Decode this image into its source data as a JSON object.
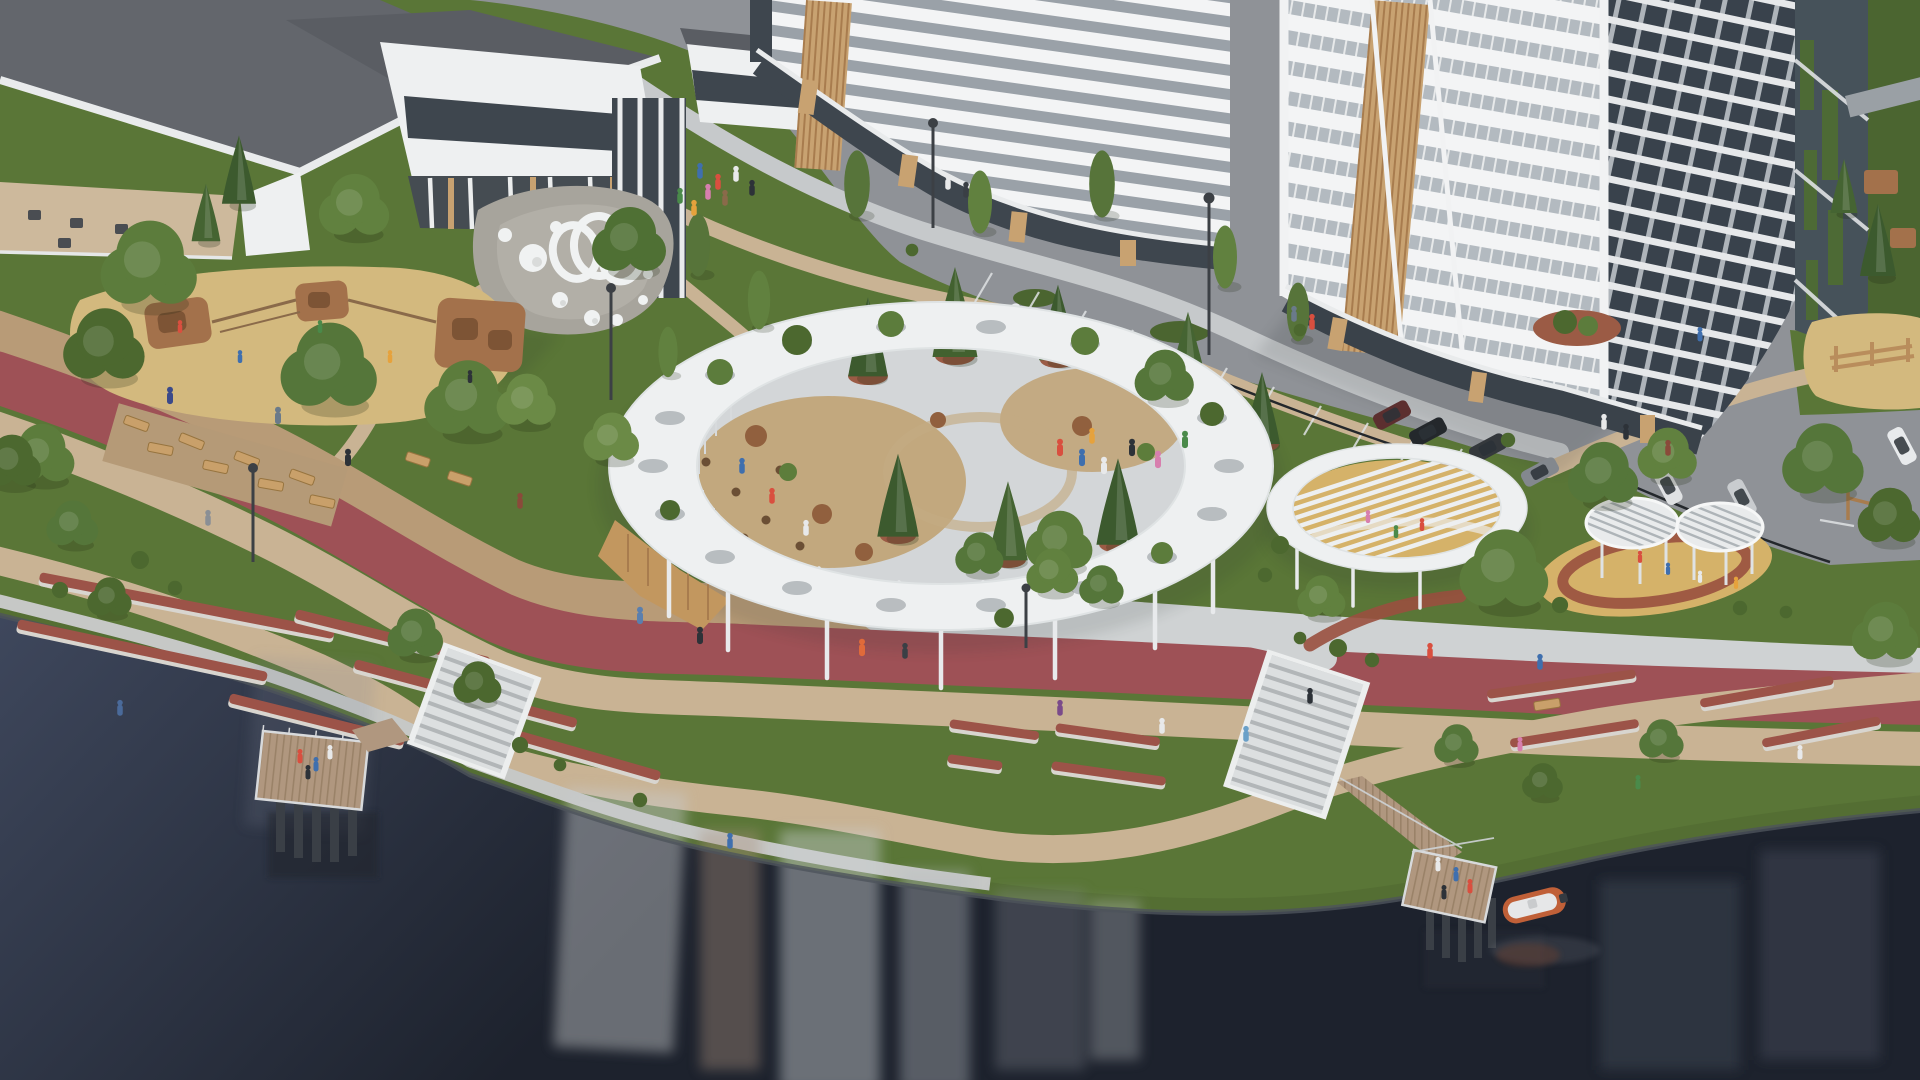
{
  "meta": {
    "scene_title": "Aerial 3D architectural rendering of a riverside residential park",
    "render_type": "photorealistic masterplan visualization",
    "visible_text": "none"
  },
  "colors": {
    "grass": "#5a7637",
    "grassDark": "#4b6530",
    "grassBank": "#546e33",
    "water": "#3d4659",
    "waterDeep": "#202633",
    "track": "#9e5156",
    "path": "#c9b394",
    "paver": "#b89b77",
    "road": "#8f9297",
    "sidewalk": "#c7cacc",
    "concrete": "#d9dcdd",
    "whiteStruct": "#eef0f1",
    "ringShade": "#c6cbcd",
    "roofDark": "#63666c",
    "roofMid": "#5a5d63",
    "glass": "#3e464e",
    "balconyGlass": "#39424c",
    "wood": "#c8a271",
    "woodDark": "#a87c4e",
    "woodDeck": "#b0977f",
    "sand": "#d3b97e",
    "rubber": "#d5b269",
    "rubberRing": "#99503f",
    "planter": "#9b5b45",
    "shrubRed": "#91603e",
    "treeGreen": "#5c7c3c",
    "treeLight": "#6b8a46",
    "treeDark": "#4c682f",
    "conifer": "#3c5a2e",
    "sculpture": "#f0f2f2",
    "gravel": "#a7a49c",
    "fence": "#23272b",
    "boat": "#c06038",
    "lamp": "#3c4045"
  },
  "scene": {
    "elements": [
      {
        "name": "school-building",
        "desc": "low white building with terraces, top left"
      },
      {
        "name": "mid-rise-building",
        "desc": "curved 8-storey white/gray banded block, top center"
      },
      {
        "name": "residential-tower",
        "desc": "tall banded tower with wood louvers and glass balconies, top right"
      },
      {
        "name": "central-ring-pavilion",
        "desc": "large white circular pergola with round skylight holes, trees and cafe plaza inside"
      },
      {
        "name": "slatted-pergola",
        "desc": "smaller round pergola with radial roof slats"
      },
      {
        "name": "twin-canopies",
        "desc": "two small round slatted canopies over children's playground"
      },
      {
        "name": "art-installation",
        "desc": "white rings and spheres sculpture on gravel mound"
      },
      {
        "name": "adventure-playground",
        "desc": "sand playground with wooden climbing structures, left"
      },
      {
        "name": "running-track",
        "desc": "red rubber track sweeping across the park"
      },
      {
        "name": "lawn-terraces",
        "desc": "curved seat-wall strips on sloped lawns"
      },
      {
        "name": "waterfront-promenade",
        "desc": "paths and stairs down to the river edge"
      },
      {
        "name": "viewing-piers",
        "desc": "two timber piers on piles over dark water"
      },
      {
        "name": "boat",
        "desc": "small orange boat on the river"
      },
      {
        "name": "parking",
        "desc": "asphalt parking rows with cars along the buildings"
      }
    ]
  }
}
